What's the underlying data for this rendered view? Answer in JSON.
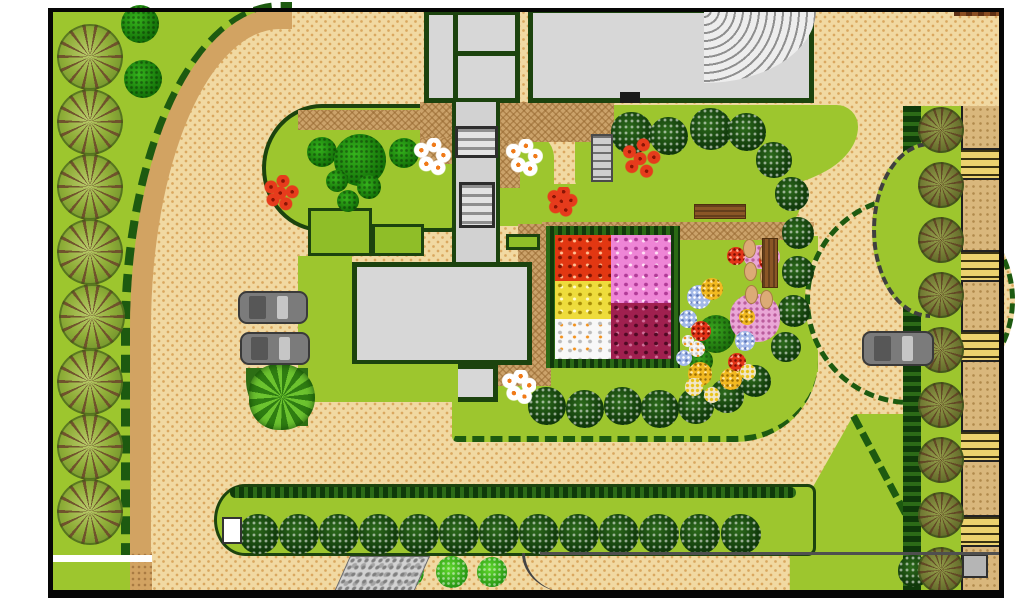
{
  "document": {
    "type": "landscape-site-plan",
    "title": "Garden landscape site plan",
    "text_labels": []
  },
  "palette": {
    "lawn": "#9dc62e",
    "outline": "#1c430e",
    "hedge": "#1d5a10",
    "plaza": "#f1d9a2",
    "plazaDot": "#d9a75e",
    "road": "#d2a362",
    "court": "#cba26a",
    "bldgFill": "#d7d7d7",
    "walkGray": "#d2d2d2",
    "boundary": "#060606"
  },
  "flower_square": {
    "quadrant_colors": [
      "red-orange",
      "pink",
      "yellow",
      "white",
      "maroon"
    ]
  },
  "objects": [
    {
      "k": "t-big",
      "cx": 90,
      "cy": 57,
      "r": 33
    },
    {
      "k": "t-big",
      "cx": 90,
      "cy": 122,
      "r": 33
    },
    {
      "k": "t-big",
      "cx": 90,
      "cy": 187,
      "r": 33
    },
    {
      "k": "t-big",
      "cx": 90,
      "cy": 252,
      "r": 33
    },
    {
      "k": "t-big",
      "cx": 92,
      "cy": 317,
      "r": 33
    },
    {
      "k": "t-big",
      "cx": 90,
      "cy": 382,
      "r": 33
    },
    {
      "k": "t-big",
      "cx": 90,
      "cy": 447,
      "r": 33
    },
    {
      "k": "t-big",
      "cx": 90,
      "cy": 512,
      "r": 33
    },
    {
      "k": "t-darkblob",
      "cx": 140,
      "cy": 24,
      "r": 19
    },
    {
      "k": "t-darkblob",
      "cx": 143,
      "cy": 79,
      "r": 19
    },
    {
      "k": "t-darkblob",
      "cx": 322,
      "cy": 152,
      "r": 15
    },
    {
      "k": "t-darkblob",
      "cx": 360,
      "cy": 160,
      "r": 26
    },
    {
      "k": "t-darkblob",
      "cx": 404,
      "cy": 153,
      "r": 15
    },
    {
      "k": "t-darkblob",
      "cx": 337,
      "cy": 181,
      "r": 11
    },
    {
      "k": "t-darkblob",
      "cx": 369,
      "cy": 187,
      "r": 12
    },
    {
      "k": "t-darkblob",
      "cx": 348,
      "cy": 201,
      "r": 11
    },
    {
      "k": "t-fluffy",
      "cx": 632,
      "cy": 133,
      "r": 21
    },
    {
      "k": "t-fluffy",
      "cx": 669,
      "cy": 136,
      "r": 19
    },
    {
      "k": "t-fluffy",
      "cx": 711,
      "cy": 129,
      "r": 21
    },
    {
      "k": "t-fluffy",
      "cx": 747,
      "cy": 132,
      "r": 19
    },
    {
      "k": "t-fluffy",
      "cx": 774,
      "cy": 160,
      "r": 18
    },
    {
      "k": "t-fluffy",
      "cx": 792,
      "cy": 194,
      "r": 17
    },
    {
      "k": "t-fluffy",
      "cx": 798,
      "cy": 233,
      "r": 16
    },
    {
      "k": "t-fluffy",
      "cx": 798,
      "cy": 272,
      "r": 16
    },
    {
      "k": "t-fluffy",
      "cx": 794,
      "cy": 311,
      "r": 16
    },
    {
      "k": "t-fluffy",
      "cx": 786,
      "cy": 347,
      "r": 15
    },
    {
      "k": "t-fluffy",
      "cx": 547,
      "cy": 406,
      "r": 19
    },
    {
      "k": "t-fluffy",
      "cx": 585,
      "cy": 409,
      "r": 19
    },
    {
      "k": "t-fluffy",
      "cx": 623,
      "cy": 406,
      "r": 19
    },
    {
      "k": "t-fluffy",
      "cx": 660,
      "cy": 409,
      "r": 19
    },
    {
      "k": "t-fluffy",
      "cx": 696,
      "cy": 406,
      "r": 18
    },
    {
      "k": "t-fluffy",
      "cx": 727,
      "cy": 396,
      "r": 17
    },
    {
      "k": "t-fluffy",
      "cx": 755,
      "cy": 381,
      "r": 16
    },
    {
      "k": "t-fluffy",
      "cx": 259,
      "cy": 534,
      "r": 20
    },
    {
      "k": "t-fluffy",
      "cx": 299,
      "cy": 534,
      "r": 20
    },
    {
      "k": "t-fluffy",
      "cx": 339,
      "cy": 534,
      "r": 20
    },
    {
      "k": "t-fluffy",
      "cx": 379,
      "cy": 534,
      "r": 20
    },
    {
      "k": "t-fluffy",
      "cx": 419,
      "cy": 534,
      "r": 20
    },
    {
      "k": "t-fluffy",
      "cx": 459,
      "cy": 534,
      "r": 20
    },
    {
      "k": "t-fluffy",
      "cx": 499,
      "cy": 534,
      "r": 20
    },
    {
      "k": "t-fluffy",
      "cx": 539,
      "cy": 534,
      "r": 20
    },
    {
      "k": "t-fluffy",
      "cx": 579,
      "cy": 534,
      "r": 20
    },
    {
      "k": "t-fluffy",
      "cx": 619,
      "cy": 534,
      "r": 20
    },
    {
      "k": "t-fluffy",
      "cx": 659,
      "cy": 534,
      "r": 20
    },
    {
      "k": "t-fluffy",
      "cx": 700,
      "cy": 534,
      "r": 20
    },
    {
      "k": "t-fluffy",
      "cx": 741,
      "cy": 534,
      "r": 20
    },
    {
      "k": "t-fluffy",
      "cx": 914,
      "cy": 571,
      "r": 16
    },
    {
      "k": "t-olive",
      "cx": 941,
      "cy": 130,
      "r": 23
    },
    {
      "k": "t-olive",
      "cx": 941,
      "cy": 185,
      "r": 23
    },
    {
      "k": "t-olive",
      "cx": 941,
      "cy": 240,
      "r": 23
    },
    {
      "k": "t-olive",
      "cx": 941,
      "cy": 295,
      "r": 23
    },
    {
      "k": "t-olive",
      "cx": 941,
      "cy": 350,
      "r": 23
    },
    {
      "k": "t-olive",
      "cx": 941,
      "cy": 405,
      "r": 23
    },
    {
      "k": "t-olive",
      "cx": 941,
      "cy": 460,
      "r": 23
    },
    {
      "k": "t-olive",
      "cx": 941,
      "cy": 515,
      "r": 23
    },
    {
      "k": "t-olive",
      "cx": 941,
      "cy": 570,
      "r": 23
    },
    {
      "k": "t-bright",
      "cx": 408,
      "cy": 572,
      "r": 16
    },
    {
      "k": "t-bright",
      "cx": 452,
      "cy": 572,
      "r": 16
    },
    {
      "k": "t-bright",
      "cx": 492,
      "cy": 572,
      "r": 15
    },
    {
      "k": "t-leafy",
      "cx": 282,
      "cy": 397,
      "r": 33
    },
    {
      "k": "t-bright2",
      "cx": 716,
      "cy": 334,
      "r": 19
    },
    {
      "k": "t-bright2",
      "cx": 701,
      "cy": 361,
      "r": 12
    },
    {
      "k": "flw-pinkdot",
      "x": 744,
      "y": 245,
      "w": 36,
      "h": 24
    },
    {
      "k": "flw-pinkdot",
      "x": 730,
      "y": 294,
      "w": 50,
      "h": 48
    },
    {
      "k": "flw-blue",
      "cx": 699,
      "cy": 297,
      "r": 12
    },
    {
      "k": "flw-blue",
      "cx": 688,
      "cy": 319,
      "r": 9
    },
    {
      "k": "flw-blue",
      "cx": 745,
      "cy": 341,
      "r": 10
    },
    {
      "k": "flw-blue",
      "cx": 684,
      "cy": 358,
      "r": 8
    },
    {
      "k": "flw-gold",
      "cx": 712,
      "cy": 289,
      "r": 11
    },
    {
      "k": "flw-gold",
      "cx": 700,
      "cy": 374,
      "r": 12
    },
    {
      "k": "flw-gold",
      "cx": 731,
      "cy": 379,
      "r": 11
    },
    {
      "k": "flw-gold",
      "cx": 747,
      "cy": 317,
      "r": 8
    },
    {
      "k": "flw-red",
      "cx": 736,
      "cy": 256,
      "r": 9
    },
    {
      "k": "flw-red",
      "cx": 768,
      "cy": 261,
      "r": 9
    },
    {
      "k": "flw-red",
      "cx": 701,
      "cy": 331,
      "r": 10
    },
    {
      "k": "flw-red",
      "cx": 737,
      "cy": 362,
      "r": 9
    },
    {
      "k": "flw-white",
      "cx": 697,
      "cy": 349,
      "r": 8
    },
    {
      "k": "flw-white",
      "cx": 688,
      "cy": 341,
      "r": 6
    },
    {
      "k": "flw-dotyellow",
      "cx": 694,
      "cy": 387,
      "r": 9
    },
    {
      "k": "flw-dotyellow",
      "cx": 712,
      "cy": 395,
      "r": 8
    },
    {
      "k": "flw-dotyellow",
      "cx": 748,
      "cy": 372,
      "r": 8
    },
    {
      "k": "stone",
      "x": 743,
      "y": 239,
      "w": 13,
      "h": 19
    },
    {
      "k": "stone",
      "x": 759,
      "y": 244,
      "w": 13,
      "h": 19
    },
    {
      "k": "stone",
      "x": 744,
      "y": 262,
      "w": 13,
      "h": 19
    },
    {
      "k": "stone",
      "x": 760,
      "y": 267,
      "w": 13,
      "h": 19
    },
    {
      "k": "stone",
      "x": 745,
      "y": 285,
      "w": 13,
      "h": 19
    },
    {
      "k": "stone",
      "x": 760,
      "y": 290,
      "w": 13,
      "h": 19
    },
    {
      "k": "daisies",
      "cx": 432,
      "cy": 157,
      "r": 19
    },
    {
      "k": "daisies",
      "cx": 524,
      "cy": 158,
      "r": 19
    },
    {
      "k": "daisies",
      "cx": 519,
      "cy": 387,
      "r": 17
    },
    {
      "k": "redflowers",
      "cx": 281,
      "cy": 195,
      "r": 20
    },
    {
      "k": "redflowers",
      "cx": 562,
      "cy": 203,
      "r": 16
    },
    {
      "k": "redflowers",
      "cx": 641,
      "cy": 161,
      "r": 23
    },
    {
      "k": "bench-h",
      "x": 694,
      "y": 204,
      "w": 52,
      "h": 15
    },
    {
      "k": "table-v",
      "x": 762,
      "y": 238,
      "w": 16,
      "h": 50
    },
    {
      "k": "bench-w",
      "x": 222,
      "y": 517,
      "w": 20,
      "h": 27
    },
    {
      "k": "gate",
      "x": 962,
      "y": 554,
      "w": 26,
      "h": 24
    },
    {
      "k": "stairs-sm",
      "x": 591,
      "y": 134,
      "w": 22,
      "h": 48
    },
    {
      "k": "pergola",
      "x": 455,
      "y": 126,
      "w": 43,
      "h": 32
    },
    {
      "k": "pergola",
      "x": 459,
      "y": 182,
      "w": 36,
      "h": 46
    },
    {
      "k": "car",
      "x": 238,
      "y": 291,
      "w": 70,
      "h": 33
    },
    {
      "k": "car",
      "x": 240,
      "y": 332,
      "w": 70,
      "h": 33
    },
    {
      "k": "car",
      "x": 862,
      "y": 331,
      "w": 72,
      "h": 35
    }
  ]
}
